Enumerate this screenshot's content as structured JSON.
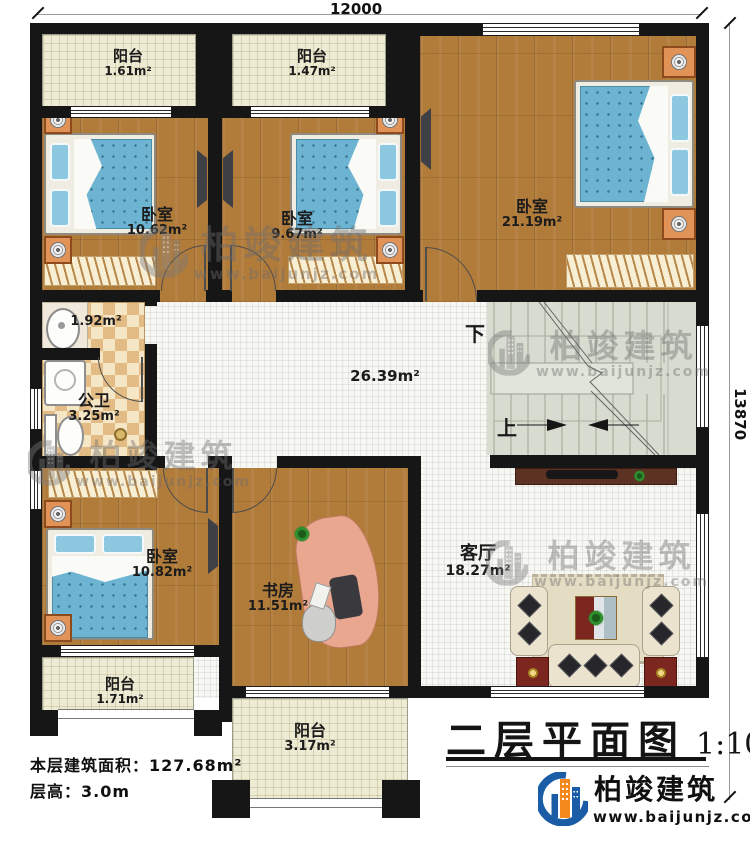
{
  "dimensions": {
    "top": "12000",
    "right": "13870"
  },
  "rooms": [
    {
      "name": "阳台",
      "area": "1.61m²"
    },
    {
      "name": "阳台",
      "area": "1.47m²"
    },
    {
      "name": "卧室",
      "area": "10.62m²"
    },
    {
      "name": "卧室",
      "area": "9.67m²"
    },
    {
      "name": "卧室",
      "area": "21.19m²"
    },
    {
      "name": "",
      "area": "1.92m²"
    },
    {
      "name": "公卫",
      "area": "3.25m²"
    },
    {
      "name": "",
      "area": "26.39m²"
    },
    {
      "name": "卧室",
      "area": "10.82m²"
    },
    {
      "name": "书房",
      "area": "11.51m²"
    },
    {
      "name": "客厅",
      "area": "18.27m²"
    },
    {
      "name": "阳台",
      "area": "1.71m²"
    },
    {
      "name": "阳台",
      "area": "3.17m²"
    }
  ],
  "stairs": {
    "down": "下",
    "up": "上"
  },
  "info": {
    "floor_area": "本层建筑面积：127.68m²",
    "floor_height": "层高：3.0m"
  },
  "title": {
    "text": "二层平面图",
    "scale": "1:100"
  },
  "logo": {
    "name": "柏竣建筑",
    "url": "www.baijunjz.com"
  },
  "watermark": {
    "text": "柏竣建筑",
    "url": "www.baijunjz.com"
  }
}
